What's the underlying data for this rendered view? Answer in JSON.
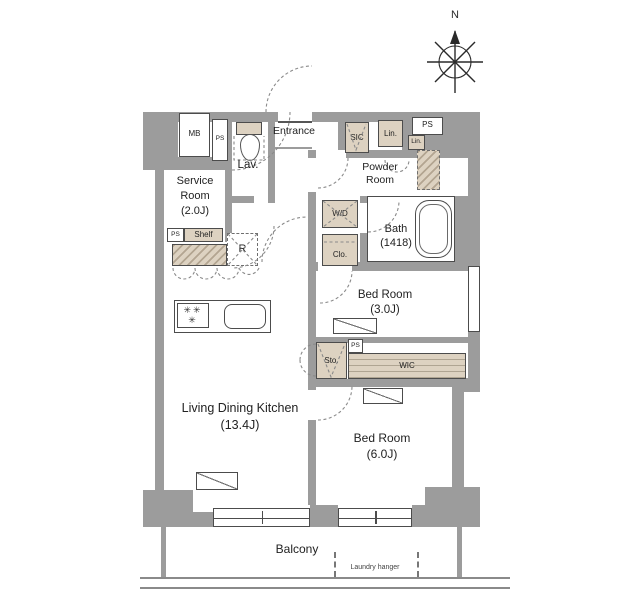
{
  "compass": {
    "north": "N"
  },
  "rooms": {
    "entrance": {
      "label": "Entrance"
    },
    "lav": {
      "label": "Lav."
    },
    "service": {
      "line1": "Service",
      "line2": "Room",
      "size": "(2.0J)"
    },
    "powder": {
      "line1": "Powder",
      "line2": "Room"
    },
    "bath": {
      "label": "Bath",
      "size": "(1418)"
    },
    "bed3": {
      "label": "Bed Room",
      "size": "(3.0J)"
    },
    "bed6": {
      "label": "Bed Room",
      "size": "(6.0J)"
    },
    "ldk": {
      "label": "Living Dining Kitchen",
      "size": "(13.4J)"
    },
    "balcony": {
      "label": "Balcony",
      "laundry": "Laundry hanger"
    }
  },
  "fixtures": {
    "mb": "MB",
    "ps_lav": "PS",
    "sic": "SIC",
    "lin": "Lin.",
    "ps_top": "PS",
    "lin_small": "Lin.",
    "wd": "W/D",
    "clo": "Clo.",
    "ps_shelf": "PS",
    "shelf": "Shelf",
    "fridge": "R",
    "sto": "Sto.",
    "ps_wic": "PS",
    "wic": "WIC",
    "burner_icon": "✳"
  },
  "colors": {
    "wall": "#9c9c9c",
    "closet_fill": "#ddd2c1",
    "line": "#4c4c4c",
    "dashed": "#8a8a8a"
  }
}
